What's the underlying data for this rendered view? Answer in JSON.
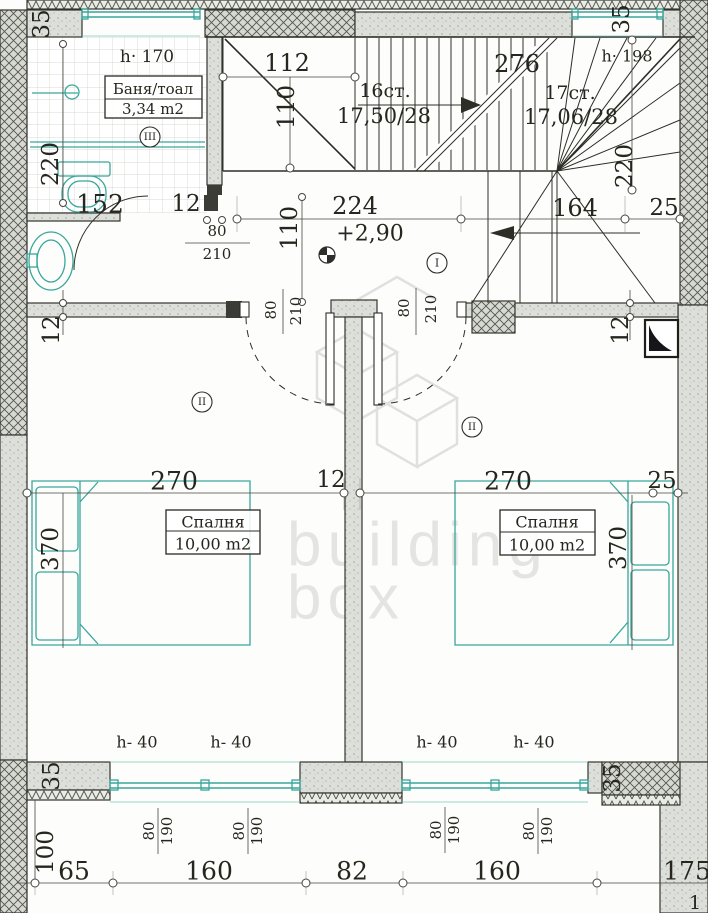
{
  "plan": {
    "bathroom": {
      "name": "Баня/тоал",
      "area": "3,34 m2",
      "ceiling": "h· 170",
      "zone": "III"
    },
    "bedroom_left": {
      "name": "Спалня",
      "area": "10,00 m2",
      "zone": "II"
    },
    "bedroom_right": {
      "name": "Спалня",
      "area": "10,00 m2",
      "zone": "II"
    },
    "hall": {
      "level": "+2,90",
      "zone": "I"
    },
    "stairs": {
      "flight_a": {
        "steps": "16ст.",
        "rise_run": "17,50/28"
      },
      "flight_b": {
        "steps": "17ст.",
        "rise_run": "17,06/28"
      },
      "headroom": "h· 198"
    },
    "windows": {
      "sill_height": "h- 40",
      "w": "80",
      "h": "190"
    },
    "doors": {
      "w": "80",
      "h": "210"
    },
    "dims": {
      "d35": "35",
      "d112": "112",
      "d110": "110",
      "d152": "152",
      "d12": "12",
      "d220": "220",
      "d224": "224",
      "d164": "164",
      "d25": "25",
      "d276": "276",
      "d270": "270",
      "d370": "370",
      "d100": "100",
      "d65": "65",
      "d160": "160",
      "d82": "82",
      "d175": "175"
    },
    "sheet_number": "1",
    "watermark": {
      "line1": "building",
      "line2": "box"
    }
  },
  "colors": {
    "teal": "#38a79c",
    "ink": "#2e2e28",
    "wall_fill": "#dde0da",
    "watermark": "#d8d8d5"
  }
}
